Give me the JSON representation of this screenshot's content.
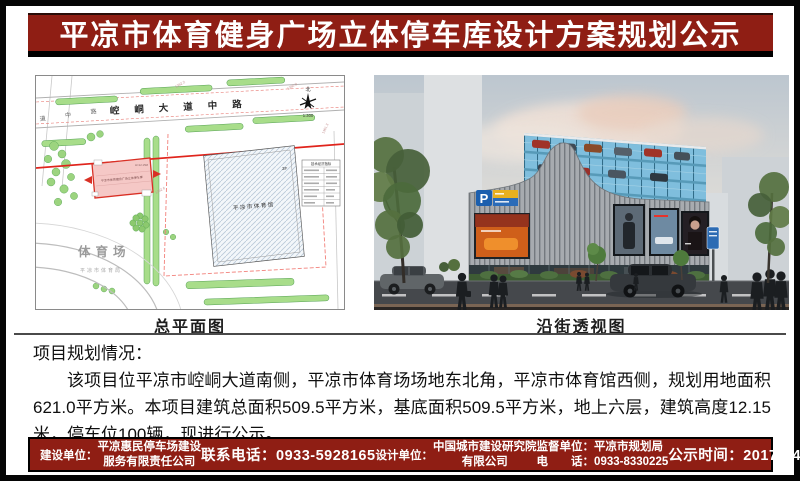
{
  "colors": {
    "banner_red": "#8f1e14",
    "frame_black": "#050505",
    "divider_gray": "#4a4a4a",
    "plan_red_line": "#e0241c",
    "render_glass_blue": "#7fbedd"
  },
  "title": "平凉市体育健身广场立体停车库设计方案规划公示",
  "site_plan": {
    "caption": "总平面图",
    "road_label": "崆峒大道中路",
    "road_label_left": "道 中 路",
    "north_label": "北",
    "scale_label": "1:300",
    "gym_label": "平凉市体育馆",
    "gym_floors": "3F",
    "parking_label": "平凉市体育健身广场立体停车库",
    "parking_note": "H=12.15M",
    "stadium_label": "体育场",
    "stadium_sublabel": "平凉市体育局",
    "table_title": "技术经济指标",
    "elevations": [
      "1362.2",
      "1360.9",
      "1361.3",
      "1362.6"
    ]
  },
  "rendering": {
    "caption": "沿街透视图",
    "parking_sign_letter": "P"
  },
  "project": {
    "heading": "项目规划情况：",
    "paragraph": "该项目位平凉市崆峒大道南侧，平凉市体育场场地东北角，平凉市体育馆西侧，规划用地面积621.0平方米。本项目建筑总面积509.5平方米，基底面积509.5平方米，地上六层，建筑高度12.15米，停车位100辆，现进行公示。"
  },
  "footer": {
    "builder_label": "建设单位：",
    "builder_line1": "平凉惠民停车场建设",
    "builder_line2": "服务有限责任公司",
    "phone": "联系电话：0933-5928165",
    "designer_label": "设计单位：",
    "designer_line1": "中国城市建设研究院",
    "designer_line2": "有限公司",
    "supervisor_line1": "监督单位：平凉市规划局",
    "supervisor_line2": "电　　话：0933-8330225",
    "period": "公示时间：2017年4月26日至5月5日"
  }
}
